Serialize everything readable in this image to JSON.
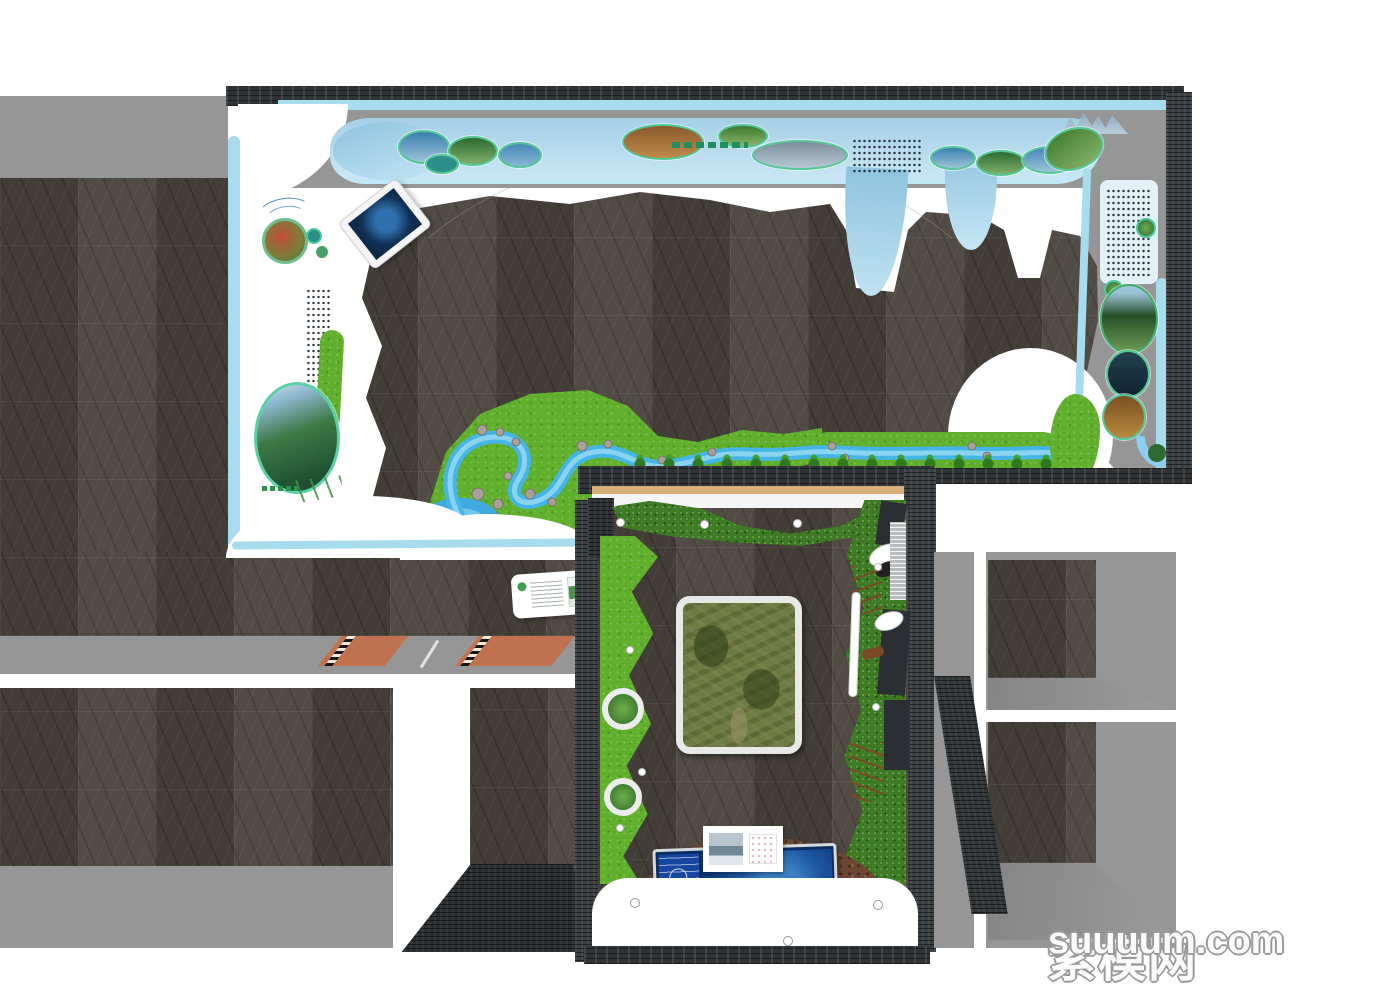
{
  "watermark": {
    "site_name": "素模网",
    "site_domain": "suuuum.com"
  },
  "palette": {
    "stone": "#4a443d",
    "slate": "#2f3336",
    "ceiling_gray": "#969696",
    "accent_cyan": "#a7dcef",
    "ribbon_blue_light": "#c9e6f4",
    "ribbon_blue": "#a6cfe6",
    "grass_green": "#61b02d",
    "shrub_green": "#3f7a24",
    "stream_blue": "#45b4e6",
    "pond_blue": "#3fa9df",
    "mat_orange": "#c0714f",
    "wood_tan": "#d8ad77",
    "screen_navy": "#0c2f63",
    "screen_panel_blue": "#1746a0",
    "photo_ring_teal": "#54c796",
    "rock_brown": "#6b4732"
  }
}
